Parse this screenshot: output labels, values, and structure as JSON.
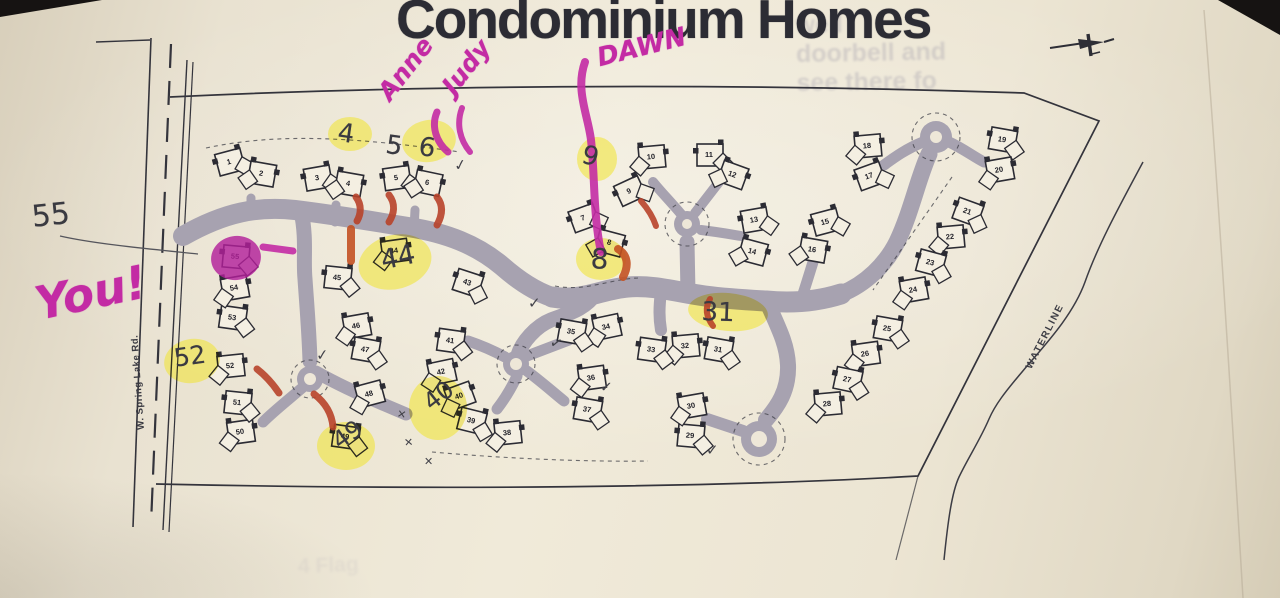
{
  "title": "Condominium Homes",
  "street_label": "W. Spring Lake Rd.",
  "waterline_label": "WATERLINE",
  "bleed_through": {
    "lines": [
      "well",
      "doorbell and",
      "see there fo"
    ],
    "bottom": "4 Flag"
  },
  "colors": {
    "paper": "#ece5d4",
    "paper_bright": "#f4efe2",
    "ink": "#2b2b33",
    "road": "#a7a2b0",
    "pencil": "#3a3a41",
    "marker_pink": "#c32ba4",
    "magenta_fill": "#b2209a",
    "highlighter_yellow": "#f0e42e",
    "marker_red": "#b8432a",
    "marker_orange_red": "#c35122"
  },
  "compass": {
    "icon": "north-arrow"
  },
  "units": [
    {
      "n": 1,
      "x": 230,
      "y": 162,
      "rot": -15
    },
    {
      "n": 2,
      "x": 262,
      "y": 174,
      "rot": 10
    },
    {
      "n": 3,
      "x": 318,
      "y": 178,
      "rot": -10
    },
    {
      "n": 4,
      "x": 349,
      "y": 184,
      "rot": 10
    },
    {
      "n": 5,
      "x": 397,
      "y": 178,
      "rot": -8
    },
    {
      "n": 6,
      "x": 428,
      "y": 183,
      "rot": 12
    },
    {
      "n": 7,
      "x": 584,
      "y": 218,
      "rot": -20
    },
    {
      "n": 8,
      "x": 610,
      "y": 243,
      "rot": 15
    },
    {
      "n": 9,
      "x": 630,
      "y": 191,
      "rot": -25
    },
    {
      "n": 10,
      "x": 652,
      "y": 157,
      "rot": -5
    },
    {
      "n": 11,
      "x": 710,
      "y": 155,
      "rot": 0
    },
    {
      "n": 12,
      "x": 733,
      "y": 175,
      "rot": 20
    },
    {
      "n": 13,
      "x": 755,
      "y": 220,
      "rot": -10
    },
    {
      "n": 14,
      "x": 753,
      "y": 252,
      "rot": 15
    },
    {
      "n": 15,
      "x": 826,
      "y": 222,
      "rot": -15
    },
    {
      "n": 16,
      "x": 813,
      "y": 250,
      "rot": 10
    },
    {
      "n": 17,
      "x": 870,
      "y": 176,
      "rot": -20
    },
    {
      "n": 18,
      "x": 868,
      "y": 146,
      "rot": -5
    },
    {
      "n": 19,
      "x": 1003,
      "y": 140,
      "rot": 10
    },
    {
      "n": 20,
      "x": 1000,
      "y": 170,
      "rot": -10
    },
    {
      "n": 21,
      "x": 968,
      "y": 212,
      "rot": 20
    },
    {
      "n": 22,
      "x": 951,
      "y": 237,
      "rot": -5
    },
    {
      "n": 23,
      "x": 931,
      "y": 263,
      "rot": 15
    },
    {
      "n": 24,
      "x": 914,
      "y": 290,
      "rot": -10
    },
    {
      "n": 25,
      "x": 888,
      "y": 329,
      "rot": 10
    },
    {
      "n": 26,
      "x": 866,
      "y": 354,
      "rot": -8
    },
    {
      "n": 27,
      "x": 848,
      "y": 380,
      "rot": 12
    },
    {
      "n": 28,
      "x": 828,
      "y": 404,
      "rot": -5
    },
    {
      "n": 29,
      "x": 691,
      "y": 436,
      "rot": 5
    },
    {
      "n": 30,
      "x": 692,
      "y": 406,
      "rot": -10
    },
    {
      "n": 31,
      "x": 719,
      "y": 350,
      "rot": 10
    },
    {
      "n": 32,
      "x": 686,
      "y": 346,
      "rot": -5
    },
    {
      "n": 33,
      "x": 652,
      "y": 350,
      "rot": 8
    },
    {
      "n": 34,
      "x": 607,
      "y": 327,
      "rot": -12
    },
    {
      "n": 35,
      "x": 572,
      "y": 332,
      "rot": 10
    },
    {
      "n": 36,
      "x": 592,
      "y": 378,
      "rot": -8
    },
    {
      "n": 37,
      "x": 588,
      "y": 410,
      "rot": 10
    },
    {
      "n": 38,
      "x": 508,
      "y": 433,
      "rot": -6
    },
    {
      "n": 39,
      "x": 472,
      "y": 421,
      "rot": 14
    },
    {
      "n": 40,
      "x": 460,
      "y": 396,
      "rot": -20
    },
    {
      "n": 41,
      "x": 451,
      "y": 341,
      "rot": 8
    },
    {
      "n": 42,
      "x": 442,
      "y": 372,
      "rot": -12
    },
    {
      "n": 43,
      "x": 468,
      "y": 283,
      "rot": 18
    },
    {
      "n": 44,
      "x": 395,
      "y": 251,
      "rot": -8
    },
    {
      "n": 45,
      "x": 338,
      "y": 278,
      "rot": 6
    },
    {
      "n": 46,
      "x": 357,
      "y": 326,
      "rot": -10
    },
    {
      "n": 47,
      "x": 366,
      "y": 350,
      "rot": 10
    },
    {
      "n": 48,
      "x": 370,
      "y": 394,
      "rot": -15
    },
    {
      "n": 49,
      "x": 346,
      "y": 437,
      "rot": 8
    },
    {
      "n": 50,
      "x": 241,
      "y": 432,
      "rot": -8
    },
    {
      "n": 51,
      "x": 238,
      "y": 403,
      "rot": 6
    },
    {
      "n": 52,
      "x": 231,
      "y": 366,
      "rot": -6
    },
    {
      "n": 53,
      "x": 233,
      "y": 318,
      "rot": 8
    },
    {
      "n": 54,
      "x": 235,
      "y": 288,
      "rot": -10
    },
    {
      "n": 55,
      "x": 236,
      "y": 257,
      "rot": 5
    }
  ],
  "handwriting": {
    "marker_notes": [
      {
        "id": "anne",
        "text": "Anne",
        "x": 372,
        "y": 88,
        "rot": -52,
        "size": 25
      },
      {
        "id": "judy",
        "text": "Judy",
        "x": 436,
        "y": 82,
        "rot": -52,
        "size": 25
      },
      {
        "id": "dawn",
        "text": "DAWN",
        "x": 594,
        "y": 44,
        "rot": -14,
        "size": 26
      },
      {
        "id": "you",
        "text": "You!",
        "x": 30,
        "y": 278,
        "rot": -12,
        "size": 46
      }
    ],
    "pencil_notes": [
      {
        "id": "55",
        "text": "55",
        "x": 30,
        "y": 200,
        "rot": -6,
        "size": 30
      },
      {
        "id": "4",
        "text": "4",
        "x": 340,
        "y": 118,
        "rot": 8,
        "size": 26
      },
      {
        "id": "5",
        "text": "5",
        "x": 388,
        "y": 130,
        "rot": 8,
        "size": 26
      },
      {
        "id": "6",
        "text": "6",
        "x": 421,
        "y": 132,
        "rot": 8,
        "size": 26
      },
      {
        "id": "9",
        "text": "9",
        "x": 586,
        "y": 140,
        "rot": 14,
        "size": 26
      },
      {
        "id": "8",
        "text": "8",
        "x": 592,
        "y": 242,
        "rot": 4,
        "size": 28
      },
      {
        "id": "44",
        "text": "44",
        "x": 378,
        "y": 246,
        "rot": -12,
        "size": 27
      },
      {
        "id": "31",
        "text": "31",
        "x": 702,
        "y": 297,
        "rot": 2,
        "size": 26
      },
      {
        "id": "52",
        "text": "52",
        "x": 172,
        "y": 344,
        "rot": -8,
        "size": 25
      },
      {
        "id": "49",
        "text": "49",
        "x": 327,
        "y": 432,
        "rot": -35,
        "size": 24
      },
      {
        "id": "40",
        "text": "40",
        "x": 418,
        "y": 394,
        "rot": -38,
        "size": 24
      }
    ],
    "checkmarks": [
      {
        "x": 454,
        "y": 156,
        "rot": -10
      },
      {
        "x": 528,
        "y": 294,
        "rot": 0
      },
      {
        "x": 550,
        "y": 334,
        "rot": 15
      },
      {
        "x": 600,
        "y": 378,
        "rot": 5
      },
      {
        "x": 316,
        "y": 346,
        "rot": -5
      },
      {
        "x": 706,
        "y": 441,
        "rot": 0
      }
    ],
    "x_marks": [
      {
        "x": 397,
        "y": 408,
        "rot": 10
      },
      {
        "x": 404,
        "y": 436,
        "rot": -5
      },
      {
        "x": 424,
        "y": 455,
        "rot": 0
      }
    ],
    "pointer_line": "M 60,236 C 95,244 150,249 198,254"
  },
  "highlights": {
    "yellow": [
      {
        "cx": 350,
        "cy": 134,
        "rx": 22,
        "ry": 17,
        "rot": 0
      },
      {
        "cx": 429,
        "cy": 141,
        "rx": 27,
        "ry": 21,
        "rot": -10
      },
      {
        "cx": 597,
        "cy": 159,
        "rx": 20,
        "ry": 22,
        "rot": 0
      },
      {
        "cx": 601,
        "cy": 259,
        "rx": 25,
        "ry": 21,
        "rot": 0
      },
      {
        "cx": 395,
        "cy": 262,
        "rx": 37,
        "ry": 27,
        "rot": -15
      },
      {
        "cx": 728,
        "cy": 312,
        "rx": 40,
        "ry": 19,
        "rot": 5
      },
      {
        "cx": 192,
        "cy": 361,
        "rx": 28,
        "ry": 22,
        "rot": -10
      },
      {
        "cx": 346,
        "cy": 446,
        "rx": 29,
        "ry": 24,
        "rot": 0
      },
      {
        "cx": 438,
        "cy": 408,
        "rx": 29,
        "ry": 32,
        "rot": 0
      }
    ],
    "magenta_blob": {
      "cx": 236,
      "cy": 258,
      "rx": 25,
      "ry": 22,
      "rot": -10,
      "unit": 55
    },
    "red_marks": [
      {
        "d": "M 356,197 C 362,205 361,214 357,221",
        "w": 7,
        "c": "red"
      },
      {
        "d": "M 389,195 C 396,204 394,214 389,222",
        "w": 7,
        "c": "red"
      },
      {
        "d": "M 437,197 C 444,206 442,216 437,225",
        "w": 7,
        "c": "red"
      },
      {
        "d": "M 351,229 L 351,261",
        "w": 8,
        "c": "orange"
      },
      {
        "d": "M 641,201 C 648,209 653,217 656,226",
        "w": 6,
        "c": "red"
      },
      {
        "d": "M 618,249 C 628,255 629,266 623,277",
        "w": 8,
        "c": "orange"
      },
      {
        "d": "M 710,299 C 704,309 707,318 713,326",
        "w": 6,
        "c": "red"
      },
      {
        "d": "M 257,369 C 266,376 273,384 279,393",
        "w": 7,
        "c": "red"
      },
      {
        "d": "M 314,394 C 327,404 332,415 333,427",
        "w": 7,
        "c": "red"
      }
    ],
    "pink_strokes": [
      {
        "d": "M 437,112 C 431,126 436,142 448,152",
        "w": 7
      },
      {
        "d": "M 462,108 C 456,124 460,140 470,152",
        "w": 6
      },
      {
        "d": "M 585,62 C 575,90 588,115 591,140 C 595,175 593,215 601,252",
        "w": 8
      },
      {
        "d": "M 263,247 L 293,251",
        "w": 7
      }
    ]
  }
}
